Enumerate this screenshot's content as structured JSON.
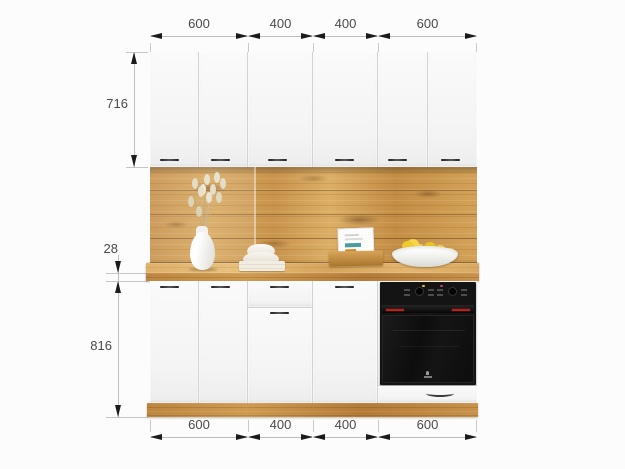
{
  "dimensions": {
    "top": [
      "600",
      "400",
      "400",
      "600"
    ],
    "bottom": [
      "600",
      "400",
      "400",
      "600"
    ],
    "left": {
      "upper_cabinets_height": "716",
      "countertop_thickness": "28",
      "base_cabinets_height": "816"
    }
  },
  "colors": {
    "wood_oak": "#cf9b52",
    "wood_counter_light": "#e0b36c",
    "cabinet_white": "#f6f6f6",
    "oven_black": "#141414",
    "oven_red_accent": "#bb1f1f",
    "lemon_yellow": "#f0ca30",
    "dimension_text": "#4a4a4a",
    "dimension_arrow": "#1b1b1b"
  }
}
